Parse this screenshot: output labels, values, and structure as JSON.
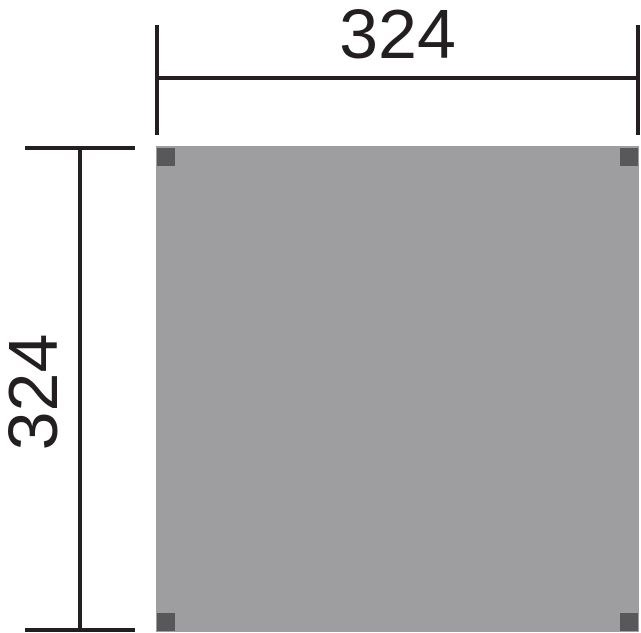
{
  "diagram": {
    "type": "dimensioned-floor-plan",
    "dimensions": {
      "width_label": "324",
      "height_label": "324"
    },
    "plan": {
      "shape": "square",
      "posts": [
        "top-left",
        "top-right",
        "bottom-left",
        "bottom-right"
      ]
    },
    "colors": {
      "line": "#231F20",
      "panel_fill": "#9E9EA1",
      "post_fill": "#58585A",
      "background": "#FFFFFF"
    }
  }
}
